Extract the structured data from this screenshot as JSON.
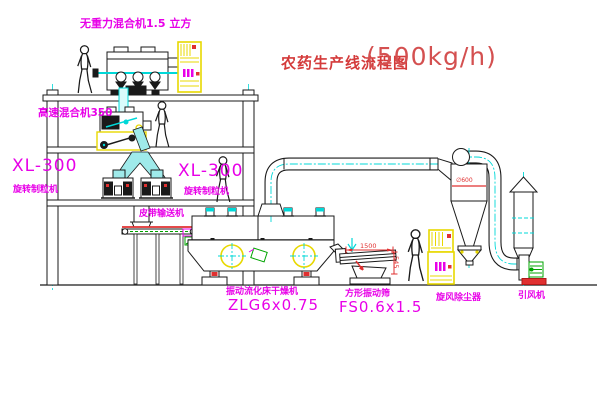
{
  "title": {
    "text": "农药生产线流程图",
    "capacity": "(500kg/h)"
  },
  "equipment_labels": {
    "gravity_free_mixer": "无重力混合机1.5 立方",
    "high_speed_mixer": "高速混合机350",
    "granulator_left": {
      "model": "XL-300",
      "name": "旋转制粒机"
    },
    "granulator_center": {
      "model": "XL-300",
      "name": "旋转制粒机"
    },
    "belt_conveyor": "皮带输送机",
    "fluid_bed_dryer": {
      "name": "振动流化床干燥机",
      "model": "ZLG6x0.75"
    },
    "square_vibrating_screen": {
      "name": "方形振动筛",
      "model": "FS0.6x1.5"
    },
    "cyclone_dust_collector": "旋风除尘器",
    "induced_draft_fan": "引风机"
  },
  "dimensions": {
    "screen_length": "1500",
    "screen_height": "545",
    "cyclone_diameter": "∅600"
  },
  "colors": {
    "label_magenta": "#e800e8",
    "title_red": "#d43a3a",
    "dimension_red": "#e03030",
    "line_black": "#1a1a1a",
    "centerline_cyan": "#00d8d8",
    "equipment_yellow": "#e8d800",
    "detail_green": "#00a400",
    "background": "#ffffff"
  }
}
